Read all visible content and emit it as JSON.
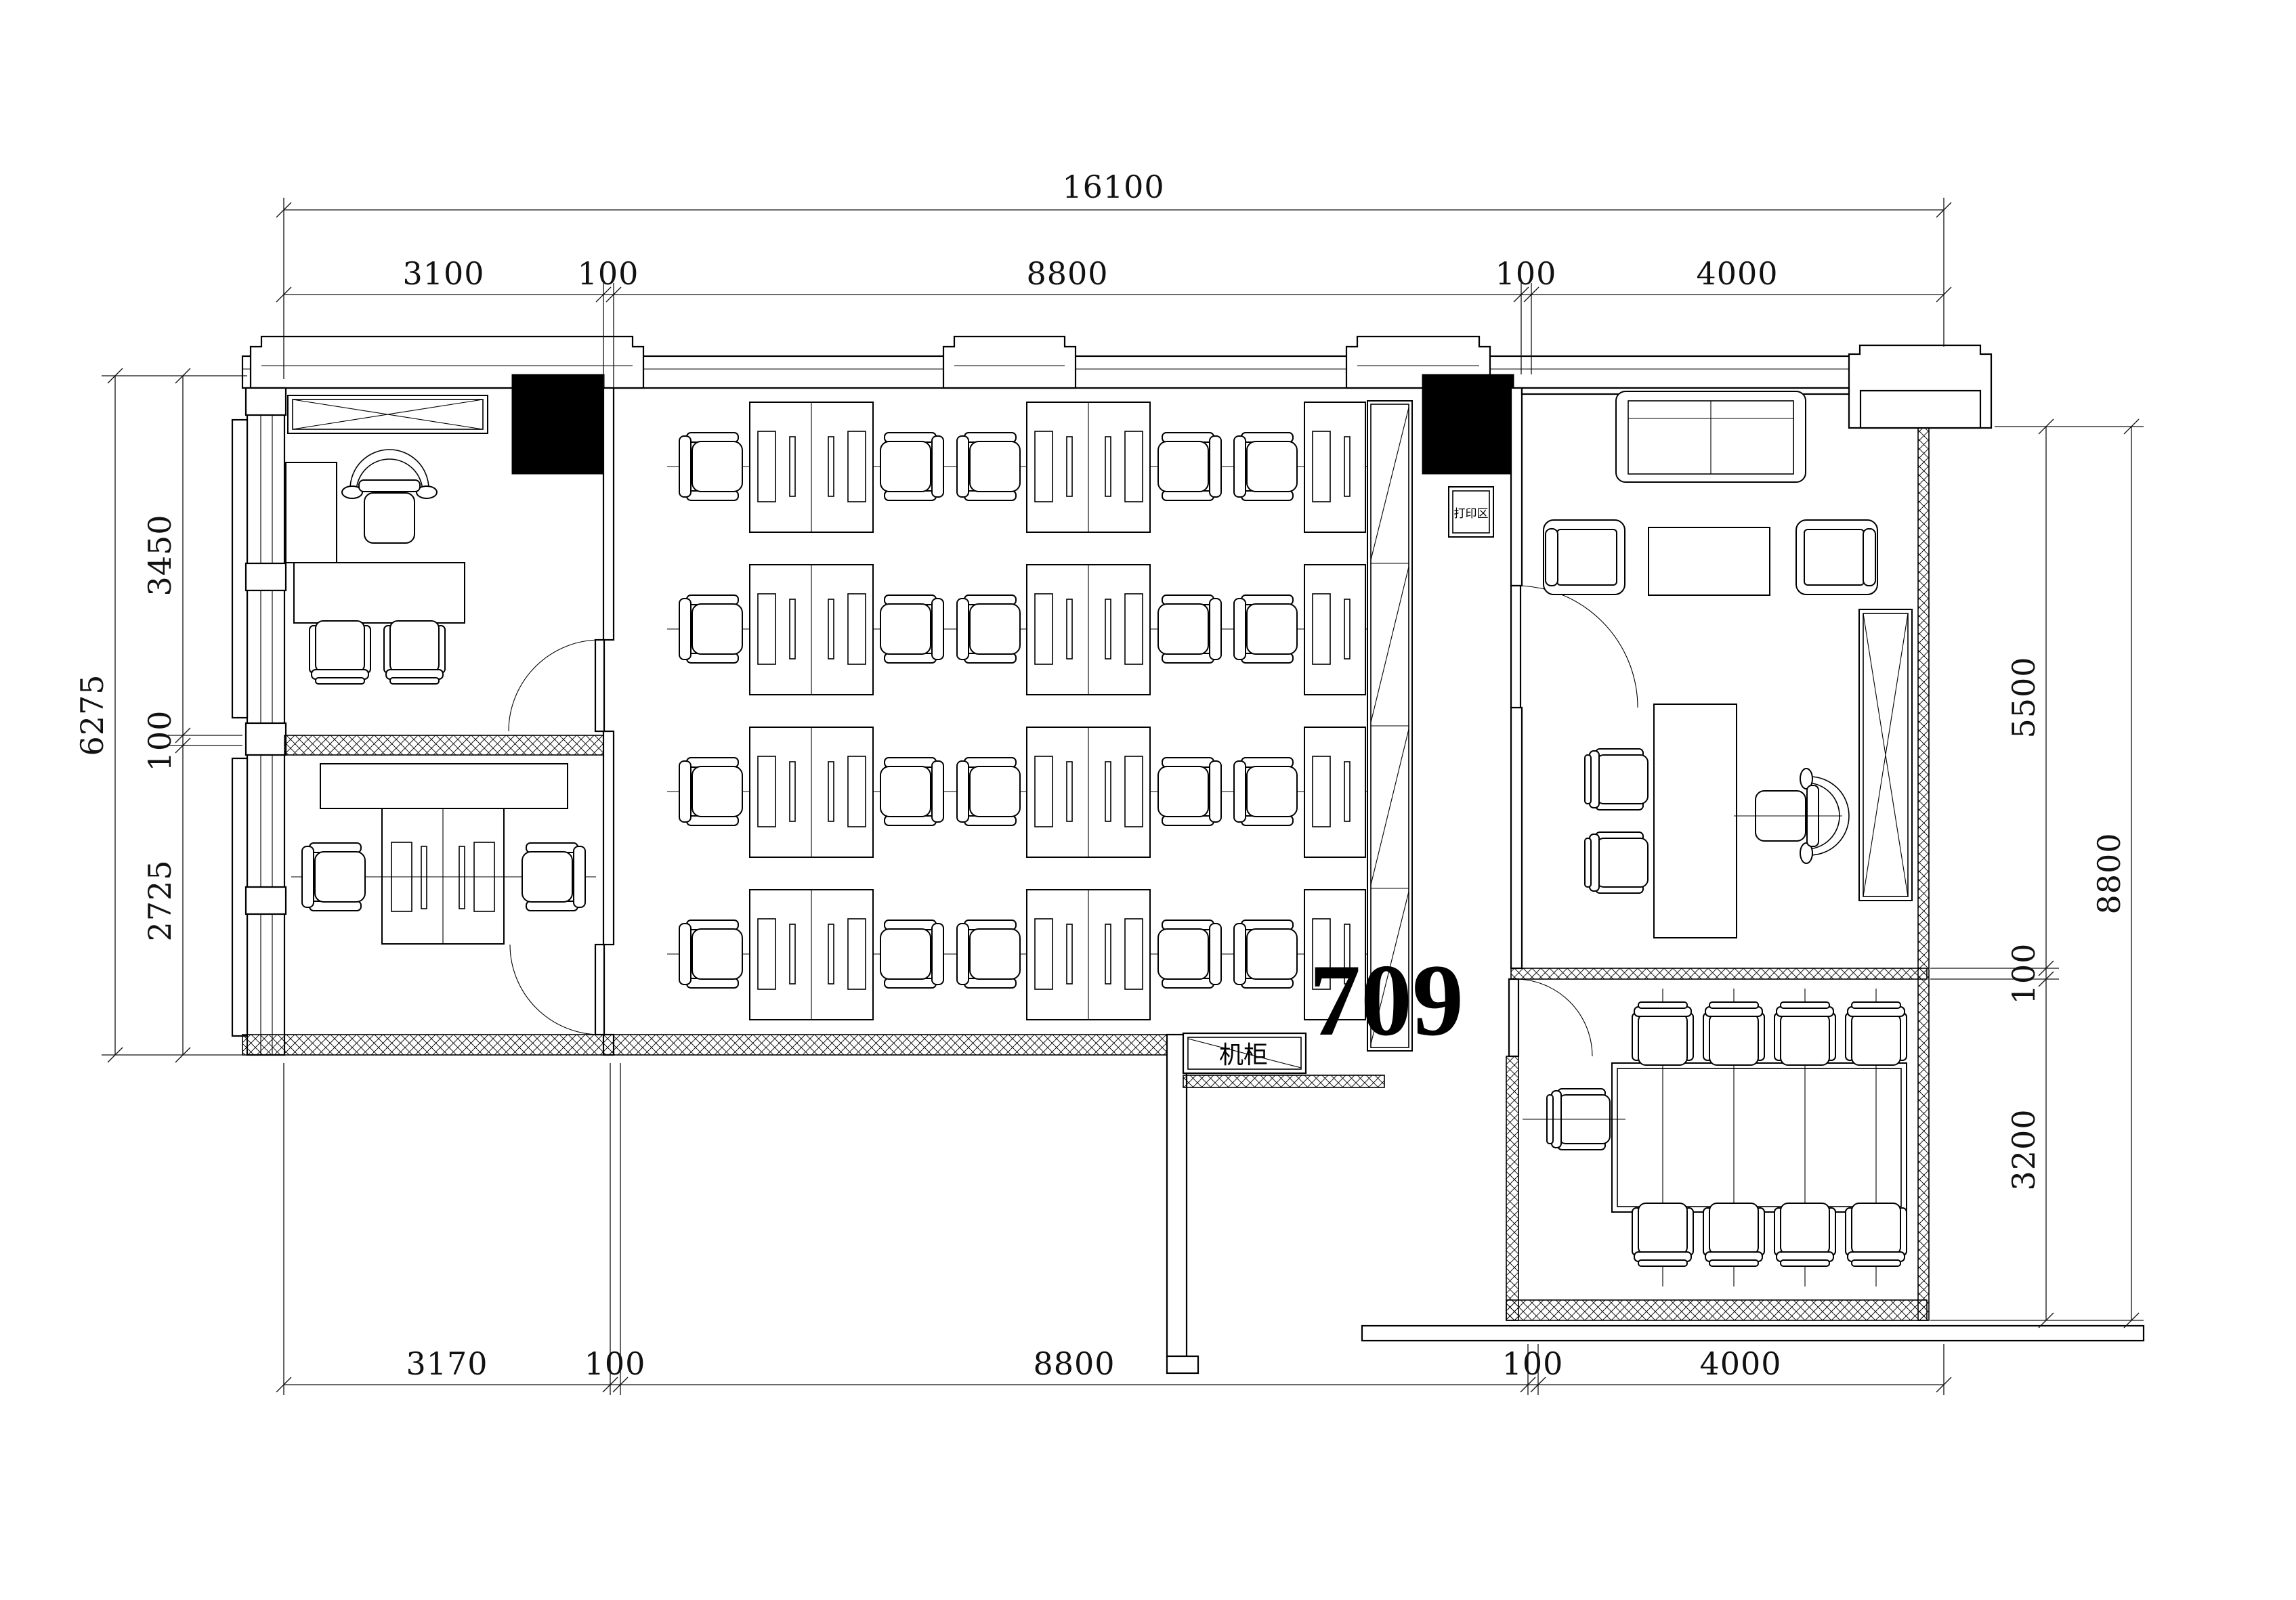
{
  "room": {
    "number": "709"
  },
  "labels": {
    "server_cabinet": "机柜",
    "print_area": "打印区"
  },
  "dimensions": {
    "top": {
      "total": "16100",
      "segments": [
        "3100",
        "100",
        "8800",
        "100",
        "4000"
      ]
    },
    "bottom": {
      "segments": [
        "3170",
        "100",
        "8800",
        "100",
        "4000"
      ]
    },
    "left": {
      "total": "6275",
      "segments": [
        "3450",
        "100",
        "2725"
      ]
    },
    "right": {
      "total": "8800",
      "segments": [
        "5500",
        "100",
        "3200"
      ]
    }
  },
  "colors": {
    "line": "#000000",
    "background": "#ffffff",
    "column_fill": "#000000"
  }
}
